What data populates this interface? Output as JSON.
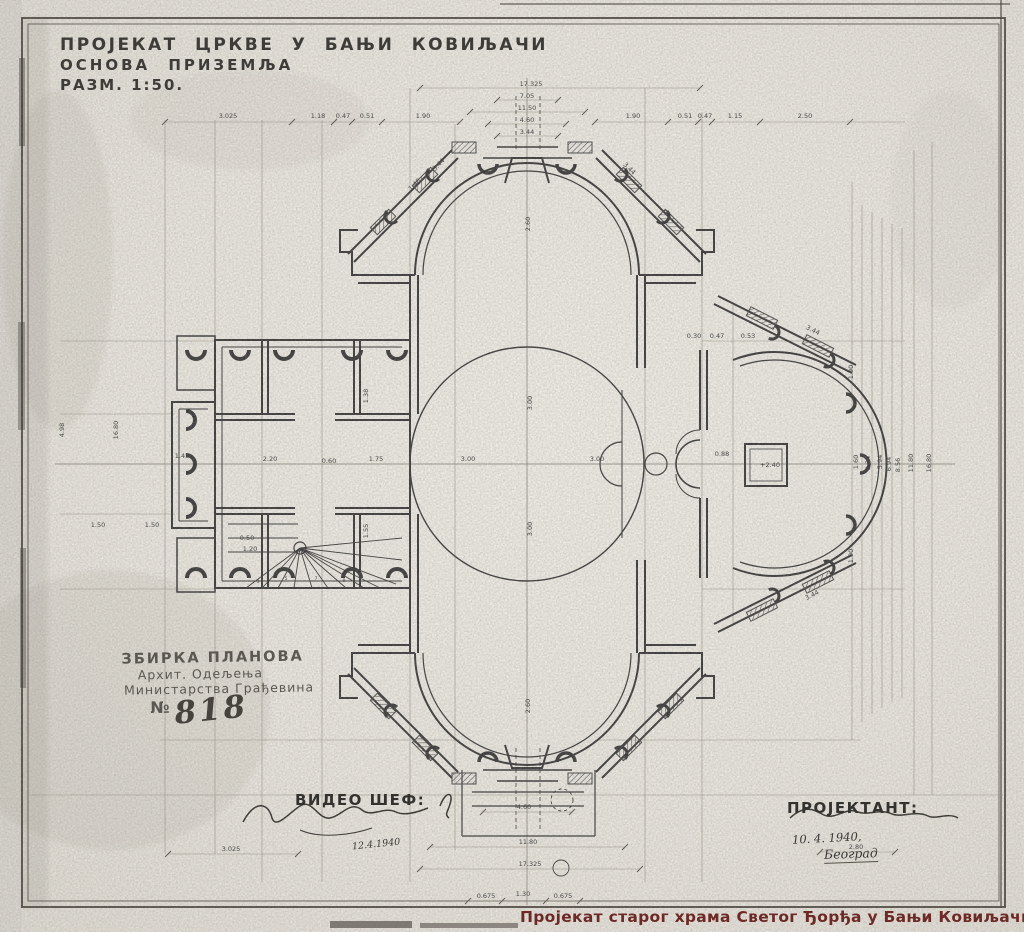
{
  "title_block": {
    "line1": "ПРОЈЕКАТ ЦРКВЕ У БАЊИ КОВИЉАЧИ",
    "line2": "ОСНОВА ПРИЗЕМЉА",
    "line3": "РАЗМ. 1:50."
  },
  "archive_stamp": {
    "line1": "ЗБИРКА ПЛАНОВА",
    "line2": "Архит. Одељења",
    "line3": "Министарства Грађевина",
    "number_prefix": "№",
    "number": "818"
  },
  "approvals": {
    "seen_by_label": "ВИДЕО ШЕФ:",
    "seen_by_date": "12.4.1940",
    "designer_label": "ПРОЈЕКТАНТ:",
    "designer_date": "10. 4. 1940,",
    "designer_place": "Београд"
  },
  "caption": {
    "text": "Пројекат старог храма Светог Ђорђа у Бањи Ковиљачи",
    "color": "#6d2926"
  },
  "plan": {
    "ink_color": "#3b3b3b",
    "paper_color": "#e9e6df",
    "labels": [
      {
        "x": 531,
        "y": 86,
        "t": "17.325"
      },
      {
        "x": 527,
        "y": 98,
        "t": "7.05"
      },
      {
        "x": 527,
        "y": 110,
        "t": "11.50"
      },
      {
        "x": 527,
        "y": 122,
        "t": "4.60"
      },
      {
        "x": 527,
        "y": 134,
        "t": "3.44"
      },
      {
        "x": 228,
        "y": 118,
        "t": "3.025"
      },
      {
        "x": 318,
        "y": 118,
        "t": "1.18"
      },
      {
        "x": 343,
        "y": 118,
        "t": "0.47"
      },
      {
        "x": 367,
        "y": 118,
        "t": "0.51"
      },
      {
        "x": 423,
        "y": 118,
        "t": "1.90"
      },
      {
        "x": 633,
        "y": 118,
        "t": "1.90"
      },
      {
        "x": 685,
        "y": 118,
        "t": "0.51"
      },
      {
        "x": 705,
        "y": 118,
        "t": "0.47"
      },
      {
        "x": 735,
        "y": 118,
        "t": "1.15"
      },
      {
        "x": 805,
        "y": 118,
        "t": "2.50"
      },
      {
        "x": 468,
        "y": 461,
        "t": "3.00"
      },
      {
        "x": 597,
        "y": 461,
        "t": "3.00"
      },
      {
        "x": 532,
        "y": 403,
        "t": "3.00",
        "r": -90
      },
      {
        "x": 532,
        "y": 529,
        "t": "3.00",
        "r": -90
      },
      {
        "x": 530,
        "y": 224,
        "t": "2.60",
        "r": -90
      },
      {
        "x": 530,
        "y": 706,
        "t": "2.60",
        "r": -90
      },
      {
        "x": 270,
        "y": 461,
        "t": "2.20"
      },
      {
        "x": 329,
        "y": 463,
        "t": "0.60"
      },
      {
        "x": 376,
        "y": 461,
        "t": "1.75"
      },
      {
        "x": 368,
        "y": 396,
        "t": "1.38",
        "r": -90
      },
      {
        "x": 368,
        "y": 531,
        "t": "1.55",
        "r": -90
      },
      {
        "x": 182,
        "y": 458,
        "t": "1.45"
      },
      {
        "x": 247,
        "y": 540,
        "t": "0.50"
      },
      {
        "x": 250,
        "y": 551,
        "t": "1.20"
      },
      {
        "x": 118,
        "y": 430,
        "t": "16.80",
        "r": -90
      },
      {
        "x": 64,
        "y": 430,
        "t": "4.98",
        "r": -90
      },
      {
        "x": 98,
        "y": 527,
        "t": "1.50"
      },
      {
        "x": 152,
        "y": 527,
        "t": "1.50"
      },
      {
        "x": 770,
        "y": 467,
        "t": "+2.40"
      },
      {
        "x": 722,
        "y": 456,
        "t": "0.88"
      },
      {
        "x": 694,
        "y": 338,
        "t": "0.30"
      },
      {
        "x": 717,
        "y": 338,
        "t": "0.47"
      },
      {
        "x": 748,
        "y": 338,
        "t": "0.53"
      },
      {
        "x": 858,
        "y": 462,
        "t": "1.60",
        "r": -90
      },
      {
        "x": 870,
        "y": 463,
        "t": "3.34",
        "r": -90
      },
      {
        "x": 882,
        "y": 462,
        "t": "5.94",
        "r": -90
      },
      {
        "x": 891,
        "y": 464,
        "t": "6.94",
        "r": -90
      },
      {
        "x": 900,
        "y": 465,
        "t": "8.56",
        "r": -90
      },
      {
        "x": 913,
        "y": 463,
        "t": "11.80",
        "r": -90
      },
      {
        "x": 931,
        "y": 463,
        "t": "16.80",
        "r": -90
      },
      {
        "x": 853,
        "y": 372,
        "t": "1.90",
        "r": -90
      },
      {
        "x": 853,
        "y": 556,
        "t": "1.90",
        "r": -90
      },
      {
        "x": 440,
        "y": 166,
        "t": "3.44",
        "r": -45
      },
      {
        "x": 416,
        "y": 186,
        "t": "1.40",
        "r": -45
      },
      {
        "x": 628,
        "y": 170,
        "t": "3.44",
        "r": 45
      },
      {
        "x": 812,
        "y": 332,
        "t": "3.44",
        "r": 27
      },
      {
        "x": 813,
        "y": 597,
        "t": "3.44",
        "r": -27
      },
      {
        "x": 524,
        "y": 809,
        "t": "4.60"
      },
      {
        "x": 528,
        "y": 844,
        "t": "11.80"
      },
      {
        "x": 530,
        "y": 866,
        "t": "17.325"
      },
      {
        "x": 486,
        "y": 898,
        "t": "0.675"
      },
      {
        "x": 523,
        "y": 896,
        "t": "1.30"
      },
      {
        "x": 563,
        "y": 898,
        "t": "0.675"
      },
      {
        "x": 231,
        "y": 851,
        "t": "3.025"
      },
      {
        "x": 856,
        "y": 849,
        "t": "2.80"
      },
      {
        "x": 258,
        "y": 583,
        "t": "3",
        "s": 4.5
      },
      {
        "x": 286,
        "y": 580,
        "t": "5",
        "s": 4.5
      },
      {
        "x": 316,
        "y": 580,
        "t": "7",
        "s": 4.5
      },
      {
        "x": 344,
        "y": 582,
        "t": "9",
        "s": 4.5
      }
    ]
  }
}
